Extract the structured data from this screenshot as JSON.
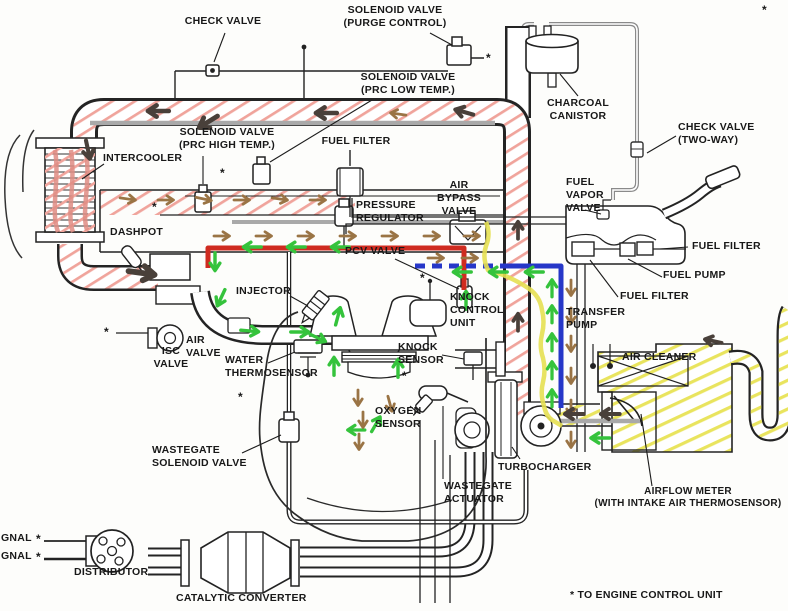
{
  "footnote_marker": "*",
  "footnote": "* TO ENGINE CONTROL UNIT",
  "labels": {
    "check_valve_top": [
      "CHECK VALVE"
    ],
    "solenoid_valve_purge": [
      "SOLENOID VALVE",
      "(PURGE CONTROL)"
    ],
    "solenoid_valve_prc_low": [
      "SOLENOID VALVE",
      "(PRC LOW TEMP.)"
    ],
    "charcoal_canistor": [
      "CHARCOAL",
      "CANISTOR"
    ],
    "check_valve_two_way": [
      "CHECK VALVE",
      "(TWO-WAY)"
    ],
    "solenoid_valve_prc_high": [
      "SOLENOID VALVE",
      "(PRC HIGH TEMP.)"
    ],
    "fuel_filter_top": [
      "FUEL FILTER"
    ],
    "intercooler": [
      "INTERCOOLER"
    ],
    "air_bypass_valve": [
      "AIR",
      "BYPASS",
      "VALVE"
    ],
    "fuel_vapor_valve": [
      "FUEL",
      "VAPOR",
      "VALVE"
    ],
    "pressure_regulator": [
      "PRESSURE",
      "REGULATOR"
    ],
    "dashpot": [
      "DASHPOT"
    ],
    "fuel_filter_right": [
      "FUEL FILTER"
    ],
    "pcv_valve": [
      "PCV VALVE"
    ],
    "fuel_pump": [
      "FUEL PUMP"
    ],
    "injector": [
      "INJECTOR"
    ],
    "knock_control_unit": [
      "KNOCK",
      "CONTROL",
      "UNIT"
    ],
    "fuel_filter_lower": [
      "FUEL FILTER"
    ],
    "transfer_pump": [
      "TRANSFER",
      "PUMP"
    ],
    "isc_valve": [
      "ISC",
      "VALVE"
    ],
    "air_valve": [
      "AIR",
      "VALVE"
    ],
    "knock_sensor": [
      "KNOCK",
      "SENSOR"
    ],
    "water_thermosensor": [
      "WATER",
      "THERMOSENSOR"
    ],
    "air_cleaner": [
      "AIR CLEANER"
    ],
    "oxygen_sensor": [
      "OXYGEN",
      "SENSOR"
    ],
    "wastegate_solenoid_valve": [
      "WASTEGATE",
      "SOLENOID VALVE"
    ],
    "turbocharger": [
      "TURBOCHARGER"
    ],
    "wastegate_actuator": [
      "WASTEGATE",
      "ACTUATOR"
    ],
    "airflow_meter": [
      "AIRFLOW METER",
      "(WITH INTAKE AIR THERMOSENSOR)"
    ],
    "signal_1": "GNAL",
    "signal_2": "GNAL",
    "distributor": [
      "DISTRIBUTOR"
    ],
    "catalytic_converter": [
      "CATALYTIC CONVERTER"
    ]
  },
  "flow_colors": {
    "boost_charge_air_hatch_pink": "#f0a49c",
    "intake_flow_green": "#35c33c",
    "pcv_line_red": "#cf2b20",
    "transfer_line_blue": "#2637c8",
    "filtered_air_yellow": "#e6e052",
    "flow_arrow_brown": "#9a7445",
    "flow_arrow_dark": "#49403a",
    "pipe_stripe_gray": "#a9a9a9"
  }
}
